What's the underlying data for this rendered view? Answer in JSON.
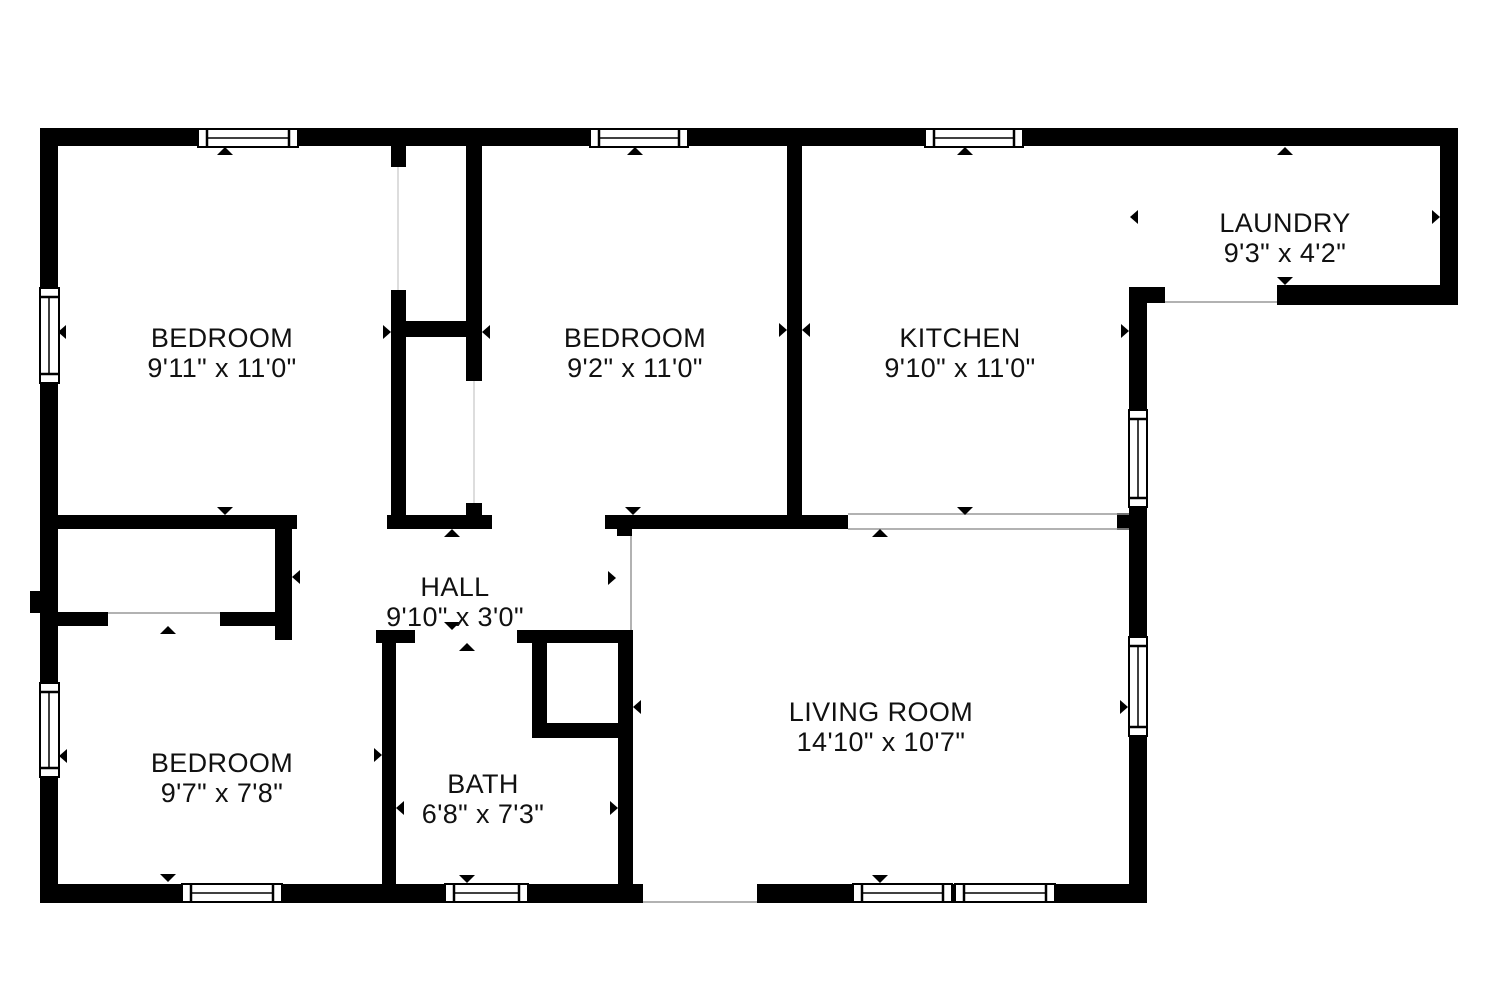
{
  "title": "Floor plan",
  "colors": {
    "wall": "#000000",
    "background": "#ffffff",
    "text": "#111111",
    "opening_line": "#999999"
  },
  "rooms": [
    {
      "name": "BEDROOM",
      "dims": "9'11\" x 11'0\""
    },
    {
      "name": "BEDROOM",
      "dims": "9'2\" x 11'0\""
    },
    {
      "name": "KITCHEN",
      "dims": "9'10\" x 11'0\""
    },
    {
      "name": "LAUNDRY",
      "dims": "9'3\" x 4'2\""
    },
    {
      "name": "HALL",
      "dims": "9'10\" x 3'0\""
    },
    {
      "name": "BEDROOM",
      "dims": "9'7\" x 7'8\""
    },
    {
      "name": "BATH",
      "dims": "6'8\" x 7'3\""
    },
    {
      "name": "LIVING ROOM",
      "dims": "14'10\" x 10'7\""
    }
  ]
}
